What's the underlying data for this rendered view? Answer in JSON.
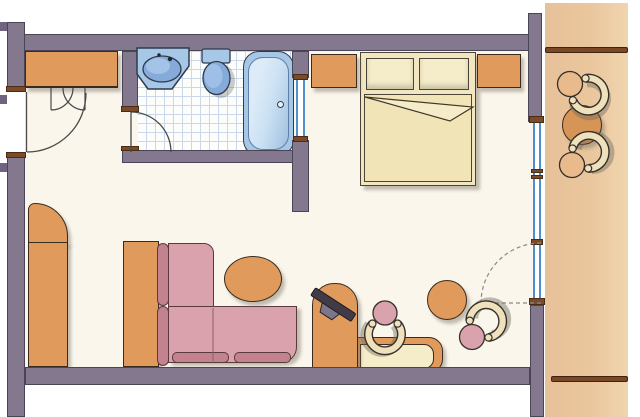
{
  "scene": {
    "kind": "hand-colored architectural floor plan of a hotel room suite"
  },
  "rooms": [
    {
      "name": "entry-hall"
    },
    {
      "name": "bathroom"
    },
    {
      "name": "bedroom-living-room"
    },
    {
      "name": "balcony"
    }
  ],
  "fixtures": {
    "bathroom": [
      "washbasin-with-counter",
      "toilet",
      "bathtub-with-drain"
    ]
  },
  "furniture": {
    "entry-hall": [
      "built-in-closet",
      "corner-wardrobe"
    ],
    "bedroom-living-room": [
      "double-bed",
      "two-pillows",
      "left-nightstand",
      "right-nightstand",
      "l-shaped-sofa",
      "console-table",
      "oval-coffee-table",
      "tv-on-cabinet",
      "desk-with-inset-top",
      "desk-chair",
      "round-stool",
      "corner-chair"
    ],
    "balcony": [
      "upper-chair",
      "round-table",
      "lower-chair",
      "upper-railing",
      "lower-railing"
    ]
  },
  "doors": [
    "entry-door-with-swing",
    "closet-double-door-swings",
    "bathroom-door-with-swing",
    "balcony-glass-door-dashed-swing"
  ],
  "windows": [
    "bathroom-interior-glazing",
    "balcony-glass-wall"
  ],
  "colors": {
    "wall-fill": "#84788F",
    "wall-line": "#4A4457",
    "cap": "#7B4A28",
    "stub": "#6E6480",
    "orange": "#DF9A5C",
    "orange-dark-line": "#3A2B1E",
    "cream": "#F1E6C0",
    "cream-light": "#F5ECC9",
    "pink": "#D9A2AC",
    "rose": "#C2838F",
    "rose-line": "#5A3A40",
    "fixture-blue": "#A6C8E6",
    "fixture-blue-deep": "#86ABDA",
    "tub-inner": "#CBE1F3",
    "fixture-line": "#2E3A4E",
    "glass": "#4E8FD0",
    "tile-line": "#CAD9E9",
    "floor": "#FAF6EC",
    "balcony-floor": "#EAC69D",
    "rail": "#7B4826",
    "band": "#EFE1BC",
    "band-line": "#35302B",
    "tv": "#403B46",
    "tv-stand": "#7D7589",
    "door-line": "#4A4A4A",
    "shadow": "rgba(125,115,100,0.45)"
  }
}
